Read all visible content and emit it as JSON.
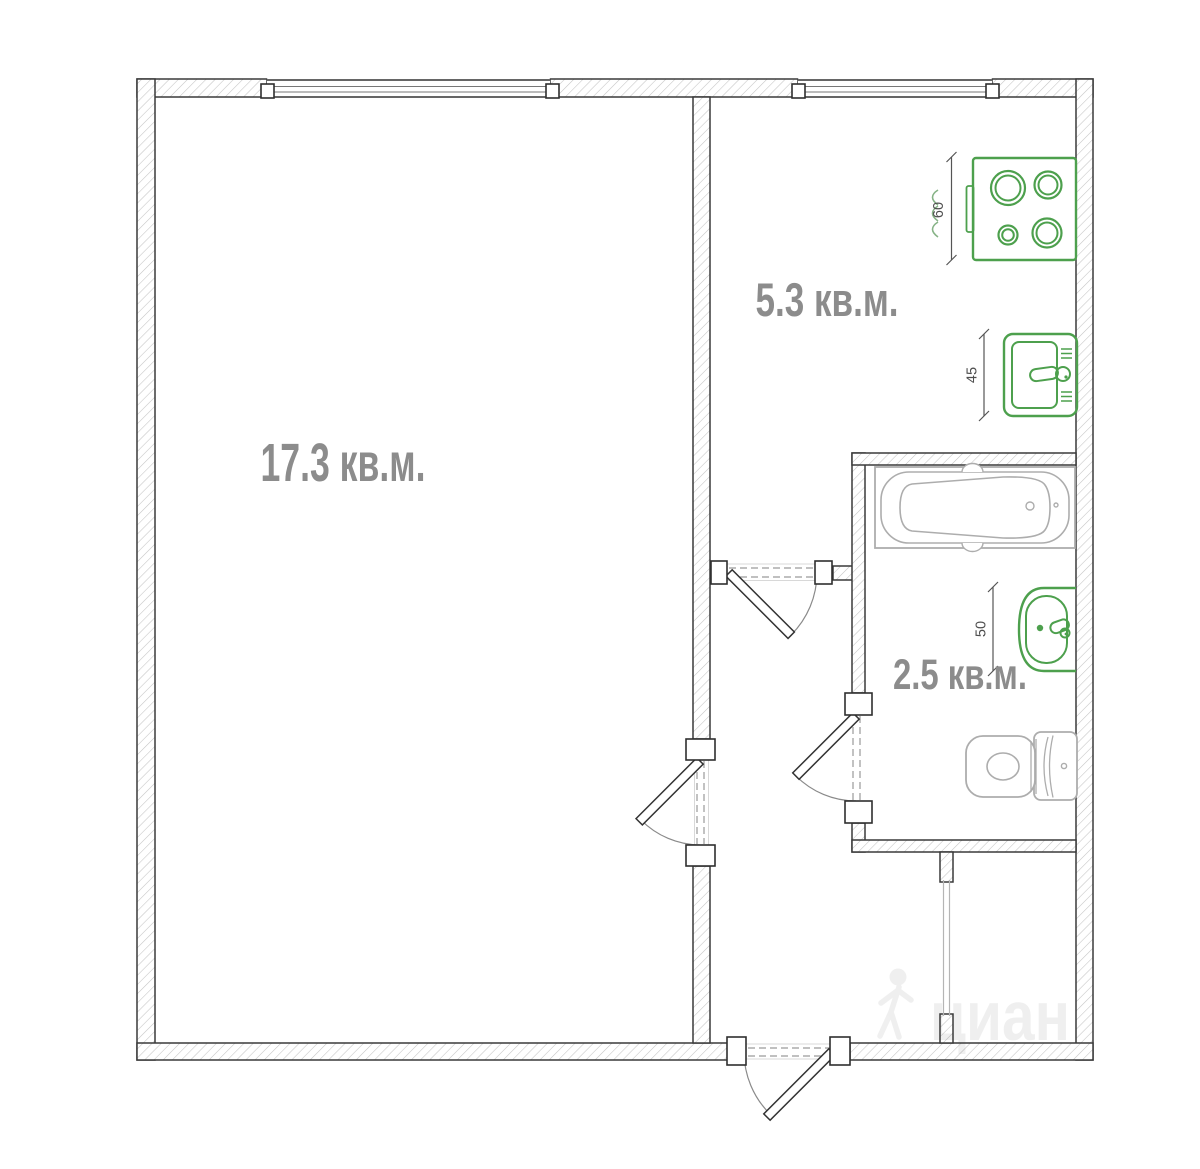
{
  "plan": {
    "type": "apartment-floorplan",
    "rooms": [
      {
        "id": "living-room",
        "label": "17.3 кв.м."
      },
      {
        "id": "kitchen",
        "label": "5.3 кв.м."
      },
      {
        "id": "bathroom",
        "label": "2.5 кв.м."
      }
    ],
    "fixture_dimensions": [
      {
        "fixture": "stove",
        "value": "60"
      },
      {
        "fixture": "kitchen-sink",
        "value": "45"
      },
      {
        "fixture": "bathroom-sink",
        "value": "50"
      }
    ],
    "fixtures": [
      "stove",
      "kitchen-sink",
      "bathtub",
      "bathroom-sink",
      "toilet"
    ],
    "watermark": {
      "brand": "циан"
    },
    "colors": {
      "fixture_green": "#4da04d",
      "fixture_gray": "#adadad",
      "label_gray": "#8c8c8c",
      "wall_edge": "#3a3a3a",
      "hatch": "#c4c4c4"
    }
  }
}
